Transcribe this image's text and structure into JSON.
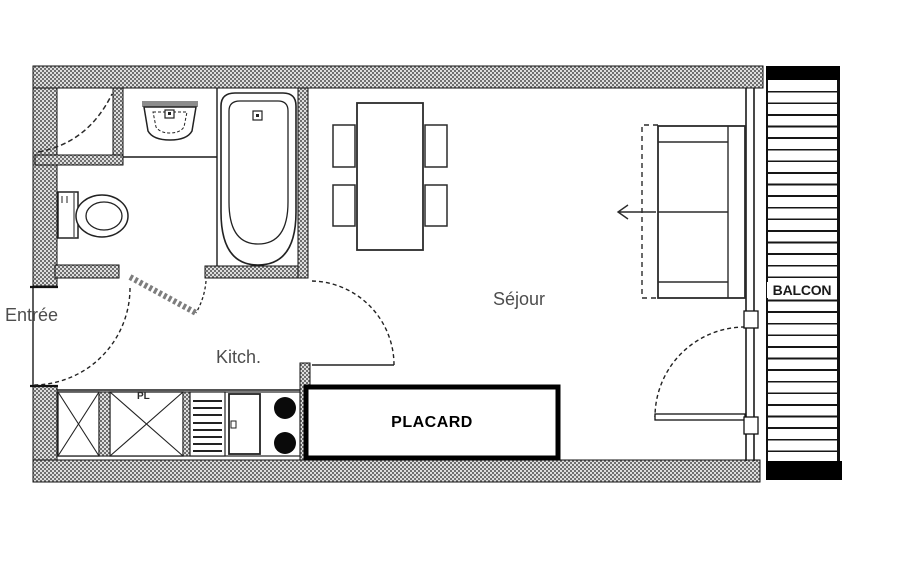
{
  "plan": {
    "labels": {
      "entree": "Entrée",
      "kitchen": "Kitch.",
      "living_room": "Séjour",
      "closet": "PLACARD",
      "balcony": "BALCON",
      "cabinet": "PL"
    },
    "colors": {
      "background": "#ffffff",
      "wall_hatch_dark": "#6f6f6f",
      "wall_hatch_light": "#dedede",
      "line": "#1a1a1a",
      "label_gray": "#4d4d4d",
      "solid_black": "#000000"
    }
  }
}
